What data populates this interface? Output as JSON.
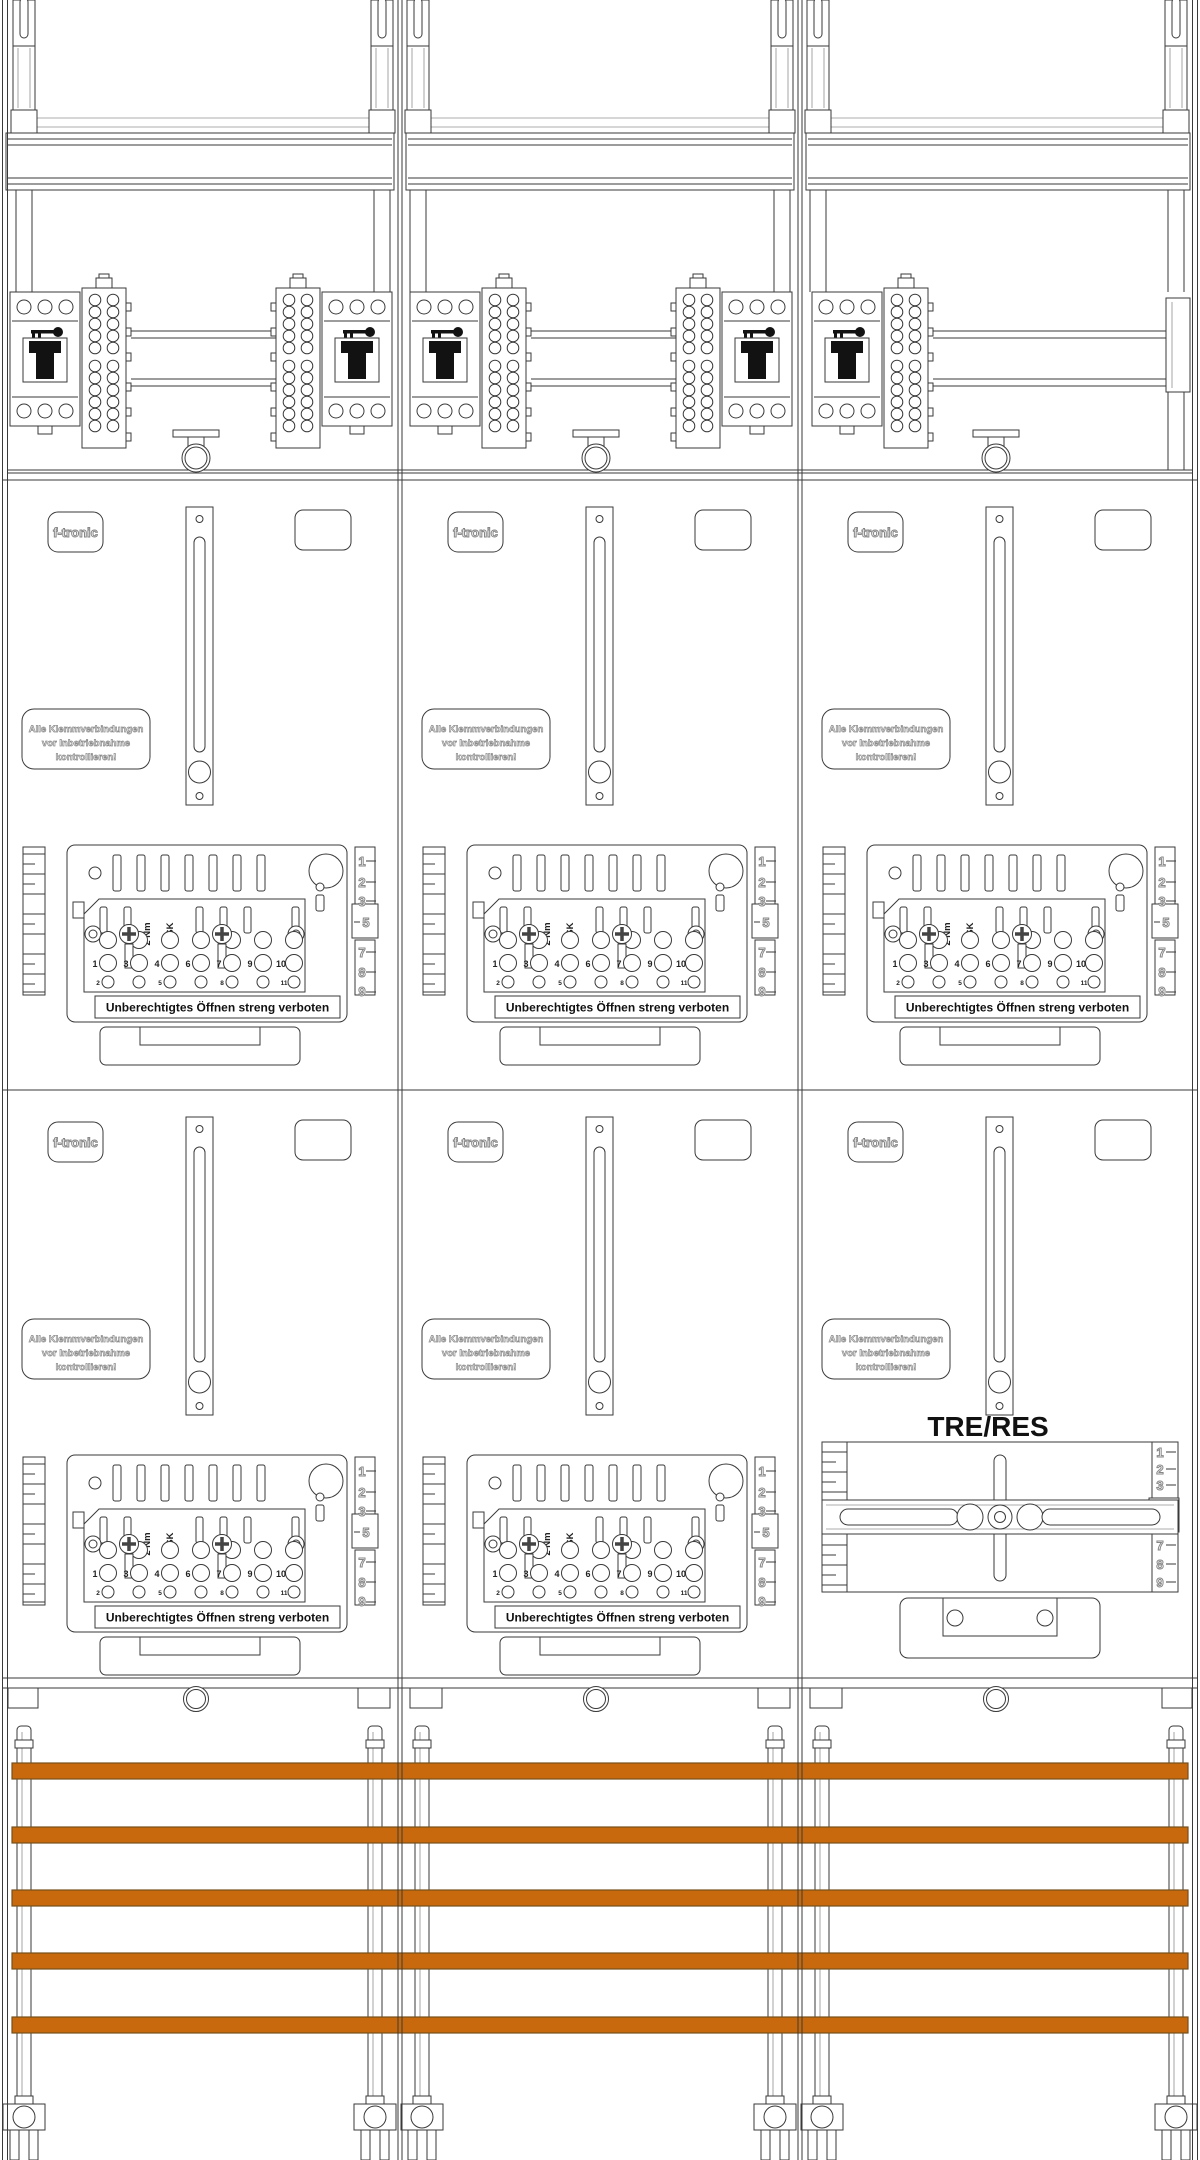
{
  "colors": {
    "busbar": "#C8690E",
    "busbar_edge": "#74511A",
    "line": "#3a3a3a"
  },
  "labels": {
    "brand": "f-tronic",
    "check_warning": [
      "Alle Klemmverbindungen",
      "vor Inbetriebnahme",
      "kontrollieren!"
    ],
    "seal_warning": "Unberechtigtes Öffnen streng verboten",
    "torque": "2 Nm",
    "unit": "ZSK",
    "reserve": "TRE/RES",
    "main_terminals": [
      "1",
      "3",
      "4",
      "6",
      "7",
      "9",
      "10"
    ],
    "aux_terminals": [
      "2",
      "5",
      "8",
      "11"
    ],
    "scale_top": [
      "1",
      "2",
      "3"
    ],
    "scale_mid": "5",
    "scale_bottom": [
      "7",
      "8",
      "9"
    ]
  }
}
